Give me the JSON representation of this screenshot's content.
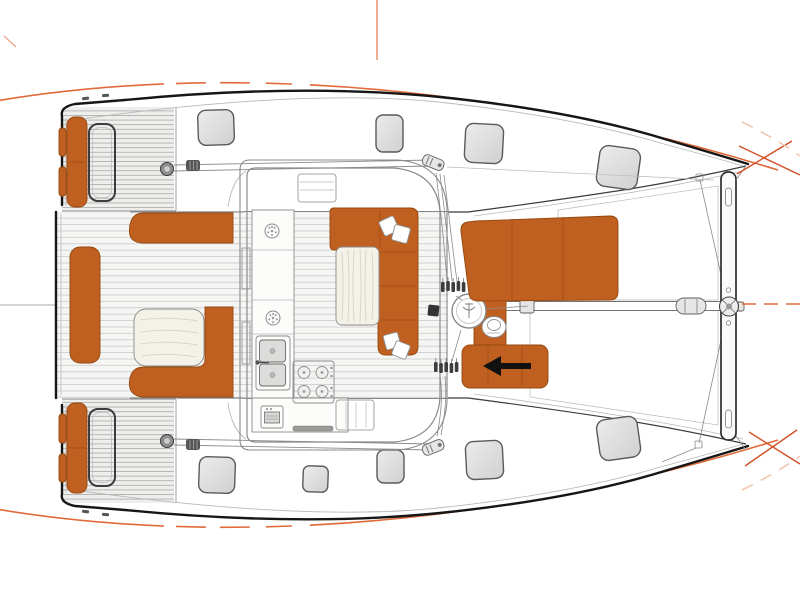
{
  "title": "catamaran-deck-layout-plan",
  "view": "top-down deck plan, bow to the right, stern to the left",
  "colors": {
    "white": "#ffffff",
    "hull-stroke": "#161616",
    "line-dark": "#3c3c3c",
    "line-mid": "#8b8b8b",
    "line-light": "#b9b9b9",
    "slat": "#c9c9c8",
    "slat-platform": "#a9a9a7",
    "bridge-fill": "#f5f5f4",
    "deck-fill": "#eeeeec",
    "counter": "#fcfcfb",
    "hatch-a": "#ececec",
    "hatch-b": "#d0d0d0",
    "hatch-stroke": "#5a5a5a",
    "orange": "#c06020",
    "orange-dark": "#94480f",
    "orange-seam": "#9c4d12",
    "dot": "#e59070",
    "guide": "#e06a3a",
    "guide-red": "#d14f28",
    "guide-faint": "#f0c7b0",
    "wood": "#f4f1e9",
    "wood-grain": "#dbd5c6",
    "metal": "#e6e6e6",
    "metal-dark": "#5f5f5f",
    "stair-light": "#f7f7f6",
    "stair-dark": "#979795"
  },
  "parts": {
    "hulls": [
      "starboard-hull",
      "port-hull"
    ],
    "stern": [
      "swim-platform",
      "transom-seat",
      "transom-frame"
    ],
    "aft_cockpit": [
      "bench-seat",
      "l-shaped-bench",
      "cockpit-table",
      "aft-center-sunpad"
    ],
    "saloon": [
      "coachroof",
      "sliding-door",
      "u-shaped-sofa",
      "saloon-table",
      "scatter-cushions"
    ],
    "galley": [
      "double-sink",
      "four-burner-stove",
      "oven",
      "deck-plate",
      "companionway-steps"
    ],
    "forward_cockpit": [
      "sunbed",
      "forward-bench-with-arrow",
      "windlass",
      "halyard-winch",
      "rope-clutches"
    ],
    "bow": [
      "trampoline-net",
      "bowsprit",
      "forward-crossbeam",
      "bow-fitting"
    ],
    "counts": {
      "deck_hatches": 9,
      "winches": 3,
      "trampoline_panels": 2,
      "sinks": 2,
      "burners": 4
    }
  }
}
